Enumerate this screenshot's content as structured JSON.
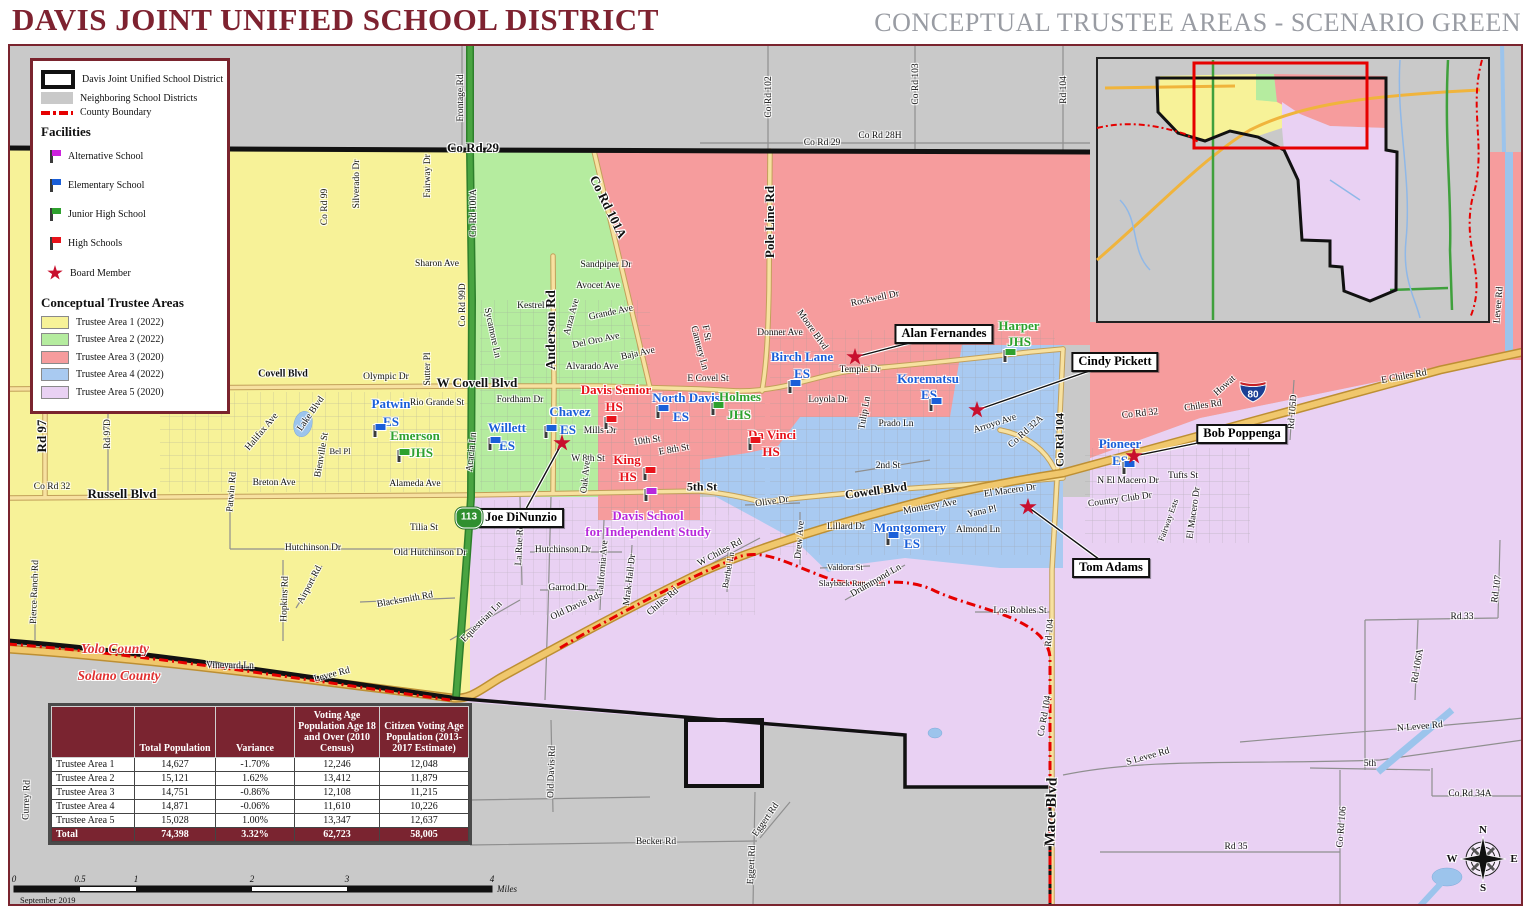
{
  "header": {
    "title": "DAVIS JOINT UNIFIED SCHOOL DISTRICT",
    "subtitle": "CONCEPTUAL TRUSTEE AREAS - SCENARIO GREEN"
  },
  "colors": {
    "maroon": "#7A242E",
    "area1": "#F7F298",
    "area2": "#B5EC9F",
    "area3": "#F69C9D",
    "area4": "#A9CAF1",
    "area5": "#E9D1F3",
    "neighboring": "#C9C9C9",
    "county_boundary": "#E60000",
    "es": "#1A5FD9",
    "jhs": "#2EA12E",
    "hs": "#E8131B",
    "alt": "#B829DC",
    "board": "#C8102E"
  },
  "legend": {
    "boundary_items": [
      {
        "label": "Davis Joint Unified School District",
        "icon": "district-outline"
      },
      {
        "label": "Neighboring School Districts",
        "icon": "gray-fill"
      },
      {
        "label": "County Boundary",
        "icon": "county-dash"
      }
    ],
    "facilities_heading": "Facilities",
    "facilities": [
      {
        "label": "Alternative School",
        "icon": "flag",
        "color": "#CC22DD"
      },
      {
        "label": "Elementary School",
        "icon": "flag",
        "color": "#1A5FD9"
      },
      {
        "label": "Junior High School",
        "icon": "flag",
        "color": "#2EA12E"
      },
      {
        "label": "High Schools",
        "icon": "flag",
        "color": "#E8131B"
      },
      {
        "label": "Board Member",
        "icon": "star",
        "color": "#C8102E"
      }
    ],
    "areas_heading": "Conceptual Trustee Areas",
    "areas": [
      {
        "label": "Trustee Area 1 (2022)",
        "color": "#F7F298"
      },
      {
        "label": "Trustee Area 2 (2022)",
        "color": "#B5EC9F"
      },
      {
        "label": "Trustee Area 3 (2020)",
        "color": "#F69C9D"
      },
      {
        "label": "Trustee Area 4 (2022)",
        "color": "#A9CAF1"
      },
      {
        "label": "Trustee Area 5 (2020)",
        "color": "#E9D1F3"
      }
    ]
  },
  "table": {
    "headers": [
      "",
      "Total Population",
      "Variance",
      "Voting Age Population Age 18 and Over (2010 Census)",
      "Citizen Voting Age Population (2013-2017 Estimate)"
    ],
    "rows": [
      [
        "Trustee Area 1",
        "14,627",
        "-1.70%",
        "12,246",
        "12,048"
      ],
      [
        "Trustee Area 2",
        "15,121",
        "1.62%",
        "13,412",
        "11,879"
      ],
      [
        "Trustee Area 3",
        "14,751",
        "-0.86%",
        "12,108",
        "11,215"
      ],
      [
        "Trustee Area 4",
        "14,871",
        "-0.06%",
        "11,610",
        "10,226"
      ],
      [
        "Trustee Area 5",
        "15,028",
        "1.00%",
        "13,347",
        "12,637"
      ]
    ],
    "total": [
      "Total",
      "74,398",
      "3.32%",
      "62,723",
      "58,005"
    ]
  },
  "map": {
    "schools": [
      {
        "name": "Patwin",
        "sub": "ES",
        "kind": "es",
        "nx": 391,
        "ny": 404,
        "tx": 391,
        "ty": 422,
        "fx": 375,
        "fy": 437
      },
      {
        "name": "Emerson",
        "sub": "JHS",
        "kind": "jhs",
        "nx": 415,
        "ny": 436,
        "tx": 421,
        "ty": 453,
        "fx": 399,
        "fy": 462
      },
      {
        "name": "Willett",
        "sub": "ES",
        "kind": "es",
        "nx": 507,
        "ny": 428,
        "tx": 507,
        "ty": 446,
        "fx": 490,
        "fy": 450
      },
      {
        "name": "Chavez",
        "sub": "ES",
        "kind": "es",
        "nx": 570,
        "ny": 412,
        "tx": 568,
        "ty": 430,
        "fx": 546,
        "fy": 438
      },
      {
        "name": "Davis Senior",
        "sub": "HS",
        "kind": "hs",
        "nx": 616,
        "ny": 390,
        "tx": 614,
        "ty": 407,
        "fx": 606,
        "fy": 429
      },
      {
        "name": "North Davis",
        "sub": "ES",
        "kind": "es",
        "nx": 686,
        "ny": 398,
        "tx": 681,
        "ty": 417,
        "fx": 658,
        "fy": 418
      },
      {
        "name": "Holmes",
        "sub": "JHS",
        "kind": "jhs",
        "nx": 740,
        "ny": 397,
        "tx": 739,
        "ty": 415,
        "fx": 713,
        "fy": 415
      },
      {
        "name": "Da Vinci",
        "sub": "HS",
        "kind": "hs",
        "nx": 772,
        "ny": 435,
        "tx": 771,
        "ty": 452,
        "fx": 750,
        "fy": 450
      },
      {
        "name": "King",
        "sub": "HS",
        "kind": "hs",
        "nx": 627,
        "ny": 460,
        "tx": 628,
        "ty": 477,
        "fx": 645,
        "fy": 480
      },
      {
        "name": "Birch Lane",
        "sub": "ES",
        "kind": "es",
        "nx": 802,
        "ny": 357,
        "tx": 802,
        "ty": 374,
        "fx": 790,
        "fy": 393
      },
      {
        "name": "Korematsu",
        "sub": "ES",
        "kind": "es",
        "nx": 928,
        "ny": 379,
        "tx": 929,
        "ty": 395,
        "fx": 931,
        "fy": 411
      },
      {
        "name": "Harper",
        "sub": "JHS",
        "kind": "jhs",
        "nx": 1019,
        "ny": 326,
        "tx": 1019,
        "ty": 342,
        "fx": 1005,
        "fy": 362
      },
      {
        "name": "Montgomery",
        "sub": "ES",
        "kind": "es",
        "nx": 910,
        "ny": 528,
        "tx": 912,
        "ty": 544,
        "fx": 888,
        "fy": 545
      },
      {
        "name": "Pioneer",
        "sub": "ES",
        "kind": "es",
        "nx": 1120,
        "ny": 444,
        "tx": 1120,
        "ty": 461,
        "fx": 1124,
        "fy": 474
      },
      {
        "name": "Davis School",
        "sub": "for Independent Study",
        "kind": "alt",
        "nx": 648,
        "ny": 516,
        "tx": 648,
        "ty": 532,
        "fx": 646,
        "fy": 501
      }
    ],
    "board_members": [
      {
        "name": "Alan Fernandes",
        "bx": 944,
        "by": 334,
        "sx": 855,
        "sy": 357
      },
      {
        "name": "Cindy Pickett",
        "bx": 1115,
        "by": 362,
        "sx": 977,
        "sy": 410
      },
      {
        "name": "Bob Poppenga",
        "bx": 1242,
        "by": 434,
        "sx": 1134,
        "sy": 456
      },
      {
        "name": "Tom Adams",
        "bx": 1111,
        "by": 568,
        "sx": 1028,
        "sy": 507
      },
      {
        "name": "Joe DiNunzio",
        "bx": 521,
        "by": 518,
        "sx": 562,
        "sy": 443
      }
    ],
    "shields": [
      {
        "kind": "interstate",
        "label": "80",
        "x": 1253,
        "y": 394
      },
      {
        "kind": "state",
        "label": "113",
        "x": 469,
        "y": 518
      }
    ],
    "county_labels": [
      {
        "t": "Yolo County",
        "x": 115,
        "y": 649
      },
      {
        "t": "Solano County",
        "x": 119,
        "y": 676
      }
    ],
    "road_labels": [
      {
        "t": "Co Rd 29",
        "x": 473,
        "y": 148,
        "s": 13,
        "b": 1
      },
      {
        "t": "Co Rd 29",
        "x": 822,
        "y": 143
      },
      {
        "t": "Co Rd 28H",
        "x": 880,
        "y": 136
      },
      {
        "t": "Frontage Rd",
        "x": 461,
        "y": 98,
        "r": -90
      },
      {
        "t": "Co Rd 102",
        "x": 769,
        "y": 97,
        "r": -90
      },
      {
        "t": "Co Rd 103",
        "x": 916,
        "y": 84,
        "r": -90
      },
      {
        "t": "Rd 104",
        "x": 1064,
        "y": 90,
        "r": -90
      },
      {
        "t": "Fairway Dr",
        "x": 428,
        "y": 176,
        "r": -90
      },
      {
        "t": "Silverado Dr",
        "x": 357,
        "y": 184,
        "r": -90
      },
      {
        "t": "Co Rd 99",
        "x": 325,
        "y": 207,
        "r": -90
      },
      {
        "t": "Co Rd 100A",
        "x": 474,
        "y": 213,
        "r": -90
      },
      {
        "t": "Co Rd 101A",
        "x": 608,
        "y": 207,
        "r": 64,
        "s": 13,
        "b": 1
      },
      {
        "t": "Pole Line Rd",
        "x": 770,
        "y": 222,
        "r": -90,
        "s": 13,
        "b": 1
      },
      {
        "t": "Sharon Ave",
        "x": 437,
        "y": 264
      },
      {
        "t": "Sandpiper Dr",
        "x": 606,
        "y": 265
      },
      {
        "t": "Avocet Ave",
        "x": 598,
        "y": 286
      },
      {
        "t": "Kestrel Pl",
        "x": 536,
        "y": 306
      },
      {
        "t": "Grande Ave",
        "x": 611,
        "y": 313,
        "r": -12
      },
      {
        "t": "Anza Ave",
        "x": 572,
        "y": 317,
        "r": -75
      },
      {
        "t": "Del Oro Ave",
        "x": 596,
        "y": 341,
        "r": -12
      },
      {
        "t": "Baja Ave",
        "x": 638,
        "y": 354,
        "r": -12
      },
      {
        "t": "Alvarado Ave",
        "x": 592,
        "y": 367
      },
      {
        "t": "Sycamore Ln",
        "x": 492,
        "y": 333,
        "r": 78
      },
      {
        "t": "Anderson Rd",
        "x": 552,
        "y": 330,
        "r": -90,
        "s": 14,
        "b": 1
      },
      {
        "t": "Sutter Pl",
        "x": 428,
        "y": 369,
        "r": -90
      },
      {
        "t": "Co Rd 99D",
        "x": 463,
        "y": 305,
        "r": -90
      },
      {
        "t": "Olympic Dr",
        "x": 386,
        "y": 377
      },
      {
        "t": "Covell Blvd",
        "x": 283,
        "y": 374,
        "s": 10,
        "b": 1
      },
      {
        "t": "Co Rd 31",
        "x": 103,
        "y": 380,
        "s": 13,
        "b": 1
      },
      {
        "t": "W Covell Blvd",
        "x": 477,
        "y": 383,
        "s": 13,
        "b": 1
      },
      {
        "t": "E Covel St",
        "x": 708,
        "y": 379
      },
      {
        "t": "F St",
        "x": 706,
        "y": 333,
        "r": 80
      },
      {
        "t": "Cannery Ln",
        "x": 699,
        "y": 348,
        "r": 75
      },
      {
        "t": "Rio Grande St",
        "x": 437,
        "y": 403
      },
      {
        "t": "Fordham Dr",
        "x": 520,
        "y": 400
      },
      {
        "t": "Halifax Ave",
        "x": 262,
        "y": 432,
        "r": -50
      },
      {
        "t": "Lake Blvd",
        "x": 311,
        "y": 414,
        "r": -55
      },
      {
        "t": "Bienville St",
        "x": 322,
        "y": 455,
        "r": -80
      },
      {
        "t": "Bel Pl",
        "x": 340,
        "y": 451,
        "s": 8.5
      },
      {
        "t": "Breton Ave",
        "x": 274,
        "y": 483
      },
      {
        "t": "Patwin Rd",
        "x": 232,
        "y": 492,
        "r": -85
      },
      {
        "t": "Rd 97D",
        "x": 108,
        "y": 434,
        "r": -90
      },
      {
        "t": "Rd 97",
        "x": 42,
        "y": 436,
        "r": -90,
        "s": 13,
        "b": 1
      },
      {
        "t": "Co Rd 32",
        "x": 52,
        "y": 487
      },
      {
        "t": "Russell Blvd",
        "x": 122,
        "y": 494,
        "s": 13,
        "b": 1
      },
      {
        "t": "Alameda Ave",
        "x": 415,
        "y": 484
      },
      {
        "t": "Acacia Ln",
        "x": 472,
        "y": 452,
        "r": -84
      },
      {
        "t": "Mills Dr",
        "x": 600,
        "y": 431
      },
      {
        "t": "10th St",
        "x": 647,
        "y": 441,
        "r": -8
      },
      {
        "t": "E 8th St",
        "x": 674,
        "y": 450,
        "r": -10
      },
      {
        "t": "W 8th St",
        "x": 588,
        "y": 459
      },
      {
        "t": "Oak Ave",
        "x": 586,
        "y": 477,
        "r": -84
      },
      {
        "t": "5th St",
        "x": 702,
        "y": 487,
        "s": 12,
        "b": 1
      },
      {
        "t": "2nd St",
        "x": 888,
        "y": 466
      },
      {
        "t": "Olive Dr",
        "x": 772,
        "y": 502,
        "r": -8
      },
      {
        "t": "Cowell Blvd",
        "x": 876,
        "y": 491,
        "r": -8,
        "s": 12,
        "b": 1
      },
      {
        "t": "Monterey Ave",
        "x": 930,
        "y": 507,
        "r": -10
      },
      {
        "t": "El Macero Dr",
        "x": 1010,
        "y": 491,
        "r": -8
      },
      {
        "t": "Yana Pl",
        "x": 982,
        "y": 512,
        "r": -12
      },
      {
        "t": "Almond Ln",
        "x": 978,
        "y": 530
      },
      {
        "t": "Lillard Dr",
        "x": 846,
        "y": 527
      },
      {
        "t": "Drew Ave",
        "x": 800,
        "y": 540,
        "r": -85
      },
      {
        "t": "Loyola Dr",
        "x": 828,
        "y": 400
      },
      {
        "t": "Tulip Ln",
        "x": 865,
        "y": 413,
        "r": -80
      },
      {
        "t": "Prado Ln",
        "x": 896,
        "y": 424
      },
      {
        "t": "Temple Dr",
        "x": 860,
        "y": 370
      },
      {
        "t": "Donner Ave",
        "x": 780,
        "y": 333
      },
      {
        "t": "Moore Blvd",
        "x": 812,
        "y": 330,
        "r": 55
      },
      {
        "t": "Rockwell Dr",
        "x": 875,
        "y": 299,
        "r": -12
      },
      {
        "t": "Arroyo Ave",
        "x": 995,
        "y": 424,
        "r": -18
      },
      {
        "t": "Co Rd 32A",
        "x": 1026,
        "y": 432,
        "r": -42
      },
      {
        "t": "Co Rd 104",
        "x": 1060,
        "y": 440,
        "r": -90,
        "s": 12,
        "b": 1
      },
      {
        "t": "Co Rd 32",
        "x": 1140,
        "y": 414,
        "r": -6
      },
      {
        "t": "Chiles Rd",
        "x": 1203,
        "y": 406,
        "r": -8
      },
      {
        "t": "Howat",
        "x": 1225,
        "y": 386,
        "r": -42
      },
      {
        "t": "Rd 105D",
        "x": 1293,
        "y": 412,
        "r": -85
      },
      {
        "t": "E Chiles Rd",
        "x": 1404,
        "y": 377,
        "r": -10
      },
      {
        "t": "Levee Rd",
        "x": 1499,
        "y": 305,
        "r": -85
      },
      {
        "t": "N El Macero Dr",
        "x": 1128,
        "y": 481
      },
      {
        "t": "Tufts St",
        "x": 1183,
        "y": 476
      },
      {
        "t": "Country Club Dr",
        "x": 1120,
        "y": 500,
        "r": -8
      },
      {
        "t": "El Macero Dr",
        "x": 1194,
        "y": 513,
        "r": -82
      },
      {
        "t": "Fairway Ests",
        "x": 1168,
        "y": 520,
        "r": -70,
        "s": 8.5
      },
      {
        "t": "Hutchinson Dr",
        "x": 313,
        "y": 548
      },
      {
        "t": "Old Hutchinson Dr",
        "x": 430,
        "y": 553
      },
      {
        "t": "Tilia St",
        "x": 424,
        "y": 528
      },
      {
        "t": "Hutchinson Dr",
        "x": 563,
        "y": 550
      },
      {
        "t": "La Rue Rd",
        "x": 520,
        "y": 545,
        "r": -87
      },
      {
        "t": "California Ave",
        "x": 603,
        "y": 568,
        "r": -85
      },
      {
        "t": "Mrak Hall Dr",
        "x": 630,
        "y": 580,
        "r": -83
      },
      {
        "t": "Garrod Dr",
        "x": 568,
        "y": 588
      },
      {
        "t": "Old Davis Rd",
        "x": 575,
        "y": 607,
        "r": -25
      },
      {
        "t": "W Chiles Rd",
        "x": 720,
        "y": 553,
        "r": -28
      },
      {
        "t": "Chiles Rd",
        "x": 663,
        "y": 602,
        "r": -40
      },
      {
        "t": "Barthel Ln",
        "x": 728,
        "y": 570,
        "r": -80,
        "s": 8.5
      },
      {
        "t": "Equestrian Ln",
        "x": 482,
        "y": 622,
        "r": -45
      },
      {
        "t": "Blacksmith Rd",
        "x": 405,
        "y": 600,
        "r": -10
      },
      {
        "t": "Hopkins Rd",
        "x": 285,
        "y": 599,
        "r": -88
      },
      {
        "t": "Airport Rd",
        "x": 310,
        "y": 585,
        "r": -62
      },
      {
        "t": "Pierce Ranch Rd",
        "x": 35,
        "y": 592,
        "r": -88
      },
      {
        "t": "Vineyard Ln",
        "x": 230,
        "y": 666
      },
      {
        "t": "Levee Rd",
        "x": 332,
        "y": 675,
        "r": -14
      },
      {
        "t": "Currey Rd",
        "x": 27,
        "y": 800,
        "r": -88
      },
      {
        "t": "Valdora St",
        "x": 845,
        "y": 567,
        "s": 8.5
      },
      {
        "t": "Slayback Ranch Ln",
        "x": 852,
        "y": 583,
        "s": 8.5
      },
      {
        "t": "Drummond Ln",
        "x": 876,
        "y": 581,
        "r": -30
      },
      {
        "t": "Los Robles St",
        "x": 1020,
        "y": 611
      },
      {
        "t": "Rd 104",
        "x": 1050,
        "y": 633,
        "r": -85
      },
      {
        "t": "Co Rd 104",
        "x": 1045,
        "y": 716,
        "r": -80
      },
      {
        "t": "Mace Blvd",
        "x": 1052,
        "y": 812,
        "r": -88,
        "s": 15,
        "b": 1
      },
      {
        "t": "S Levee Rd",
        "x": 1148,
        "y": 757,
        "r": -16
      },
      {
        "t": "N Levee Rd",
        "x": 1420,
        "y": 727,
        "r": -5
      },
      {
        "t": "Rd 33",
        "x": 1462,
        "y": 617
      },
      {
        "t": "Rd 107",
        "x": 1497,
        "y": 589,
        "r": -82
      },
      {
        "t": "Rd 106A",
        "x": 1418,
        "y": 666,
        "r": -80
      },
      {
        "t": "5th",
        "x": 1370,
        "y": 764
      },
      {
        "t": "Co Rd 34A",
        "x": 1470,
        "y": 794
      },
      {
        "t": "Co Rd 106",
        "x": 1342,
        "y": 827,
        "r": -85
      },
      {
        "t": "Rd 35",
        "x": 1236,
        "y": 847
      },
      {
        "t": "Becker Rd",
        "x": 656,
        "y": 842
      },
      {
        "t": "Eggert Rd",
        "x": 766,
        "y": 820,
        "r": -55
      },
      {
        "t": "Eggert Rd",
        "x": 752,
        "y": 865,
        "r": -87
      },
      {
        "t": "Old Davis Rd",
        "x": 552,
        "y": 772,
        "r": -88
      }
    ],
    "compass": {
      "n": "N",
      "e": "E",
      "s": "S",
      "w": "W"
    },
    "scalebar": {
      "ticks": [
        "0",
        "0.5",
        "1",
        "2",
        "3",
        "4"
      ],
      "tick_x": [
        14,
        80,
        136,
        252,
        347,
        492
      ],
      "unit": "Miles",
      "date": "September 2019"
    }
  }
}
